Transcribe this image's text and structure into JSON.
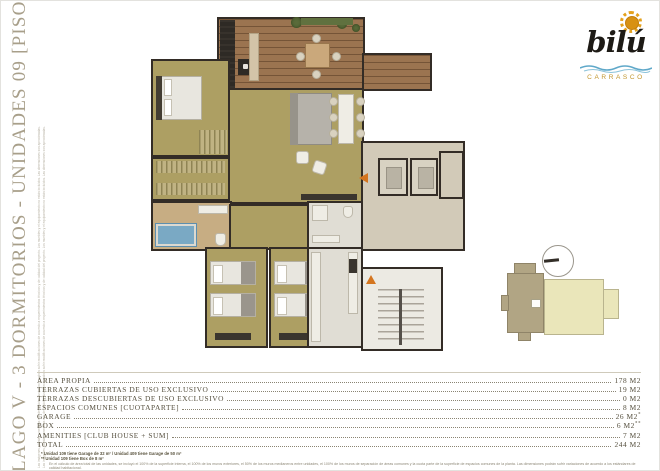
{
  "page": {
    "vertical_title": "LAGO V - 3 DORMITORIOS - UNIDADES 09 [PISO 1, 2, 3 Y 4]",
    "vertical_fineprint": "Las imágenes, plantas y medidas son de carácter ilustrativo y podrán sufrir modificaciones de acuerdo a requerimientos técnicos y de calidad del proyecto. Los muebles y el equipamiento no están incluidos. Las dimensiones son aproximadas."
  },
  "logo": {
    "brand": "bilú",
    "location": "CARRASCO",
    "colors": {
      "sun": "#e4a11d",
      "wave": "#5fa8c9",
      "location_text": "#c2952c",
      "brand_text": "#1d1a15"
    }
  },
  "key_plan": {
    "compass": "north-arrow",
    "highlight_color": "#b1a584",
    "building_color": "#eae6ba"
  },
  "plan": {
    "rooms": [
      "terraza",
      "living-comedor",
      "dormitorio-principal",
      "vestidor",
      "bano-principal",
      "dormitorio-2",
      "dormitorio-3",
      "bano-2",
      "cocina",
      "hall-acceso",
      "ascensores",
      "escalera"
    ],
    "wall_color": "#332c26",
    "floor_color": "#ad9f63",
    "deck_color": "#9b7450",
    "accent_arrow_color": "#d4751f"
  },
  "areas_table": {
    "rows": [
      {
        "label": "ÁREA PROPIA",
        "value": "178 M2",
        "sup": ""
      },
      {
        "label": "TERRAZAS CUBIERTAS DE USO EXCLUSIVO",
        "value": "19 M2",
        "sup": ""
      },
      {
        "label": "TERRAZAS DESCUBIERTAS DE USO EXCLUSIVO",
        "value": "0 M2",
        "sup": ""
      },
      {
        "label": "ESPACIOS COMUNES [CUOTAPARTE]",
        "value": "8 M2",
        "sup": ""
      },
      {
        "label": "GARAGE",
        "value": "26 M2",
        "sup": "*"
      },
      {
        "label": "BOX",
        "value": "6 M2",
        "sup": "**"
      },
      {
        "label": "AMENITIES [CLUB HOUSE + SUM]",
        "value": "7 M2",
        "sup": ""
      },
      {
        "label": "TOTAL",
        "value": "244 M2",
        "sup": ""
      }
    ]
  },
  "footnotes": {
    "line1": "* Unidad 109 tiene Garage de 32 m² / Unidad 409 tiene Garage de 50 m²",
    "line2": "** Unidad 109 tiene Box de 8 m²",
    "line3": "En el cálculo de área total de las unidades, se incluyó el 100% de la superficie interna, el 100% de los muros exteriores, el 50% de los muros medianeros entre unidades, el 100% de los muros de separación de áreas comunes y la cuota parte de la superficie de espacios comunes de la planta. Las dimensiones podrán sufrir variaciones de acuerdo a los estándares de calidad habitacional."
  }
}
